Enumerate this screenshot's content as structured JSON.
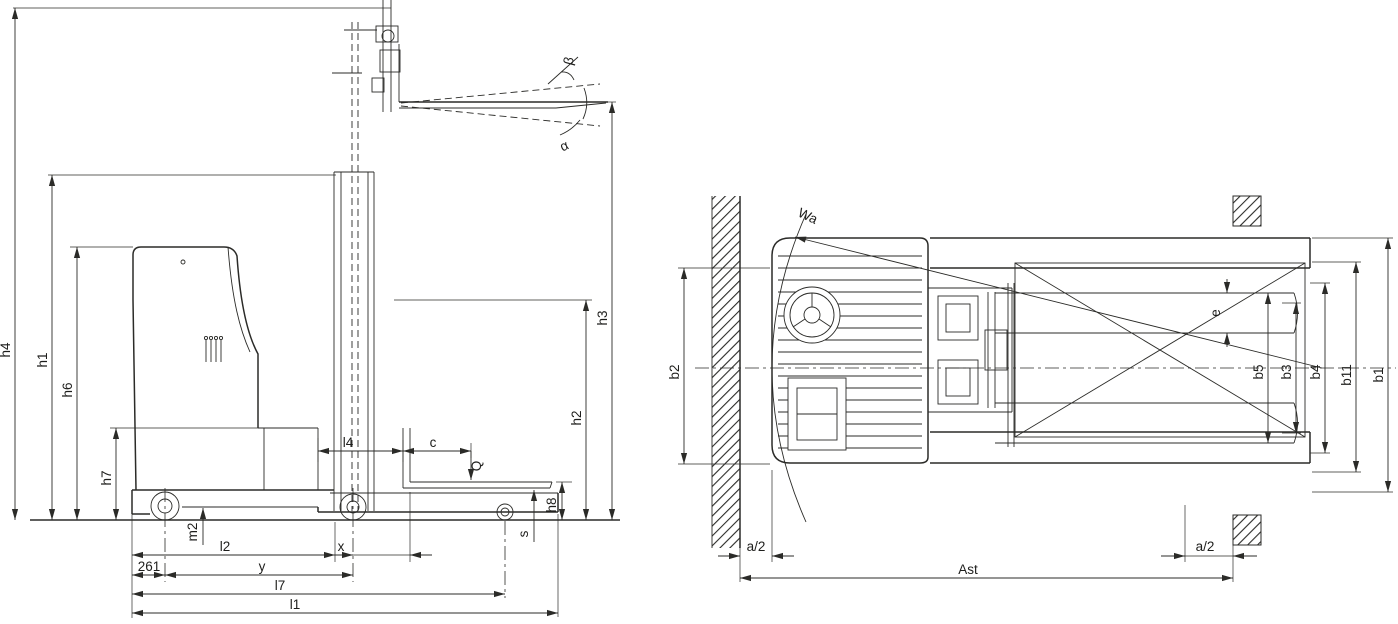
{
  "colors": {
    "background": "#ffffff",
    "ink": "#2b2b28"
  },
  "side_view": {
    "heights": {
      "h1": "h1",
      "h2": "h2",
      "h3": "h3",
      "h4": "h4",
      "h6": "h6",
      "h7": "h7",
      "h8": "h8"
    },
    "lengths": {
      "l1": "l1",
      "l2": "l2",
      "l4": "l4",
      "l7": "l7",
      "x": "x",
      "y": "y",
      "c": "c",
      "m2": "m2",
      "s": "s",
      "rear_axle_distance": "261"
    },
    "angles": {
      "alpha": "α",
      "beta": "β"
    },
    "capacity": {
      "q": "Q"
    }
  },
  "top_view": {
    "widths": {
      "b1": "b1",
      "b2": "b2",
      "b3": "b3",
      "b4": "b4",
      "b5": "b5",
      "b11": "b11",
      "e": "e"
    },
    "aisle": {
      "ast": "Ast",
      "a_half_left": "a/2",
      "a_half_right": "a/2"
    },
    "turning_radius": {
      "wa": "Wa"
    }
  }
}
